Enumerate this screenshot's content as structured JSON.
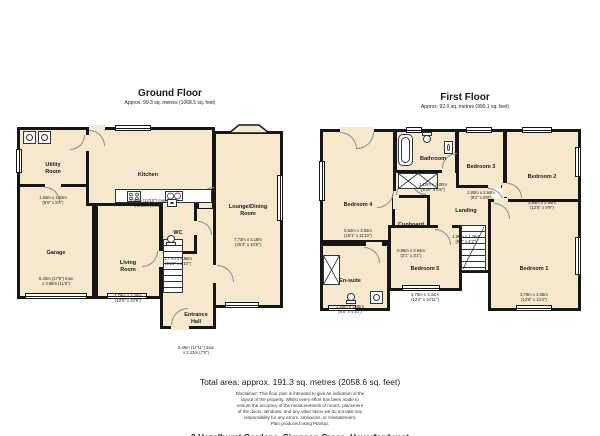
{
  "colors": {
    "room_fill": "#f6e8cd",
    "wall": "#161616",
    "background": "#ffffff"
  },
  "ground": {
    "title": "Ground Floor",
    "subtitle": "Approx. 99.3 sq. metres (1068.5 sq. feet)",
    "rooms": {
      "utility": {
        "name": "Utility\nRoom",
        "dims": "1.83m x 1.63m\n(6'0\" x 5'4\")"
      },
      "kitchen": {
        "name": "Kitchen",
        "dims": "3.90m (12'10\") max\nx 3.00m (9'10\")"
      },
      "lounge": {
        "name": "Lounge/Dining\nRoom",
        "dims": "7.73m x 3.18m\n(25'4\" x 10'5\")"
      },
      "garage": {
        "name": "Garage",
        "dims": "5.40m (17'9\") max\nx 3.58m (11'9\")"
      },
      "living": {
        "name": "Living\nRoom",
        "dims": "3.79m x 3.28m\n(12'5\" x 10'9\")"
      },
      "wc": {
        "name": "WC",
        "dims": "1.77m x 0.86m\n(5'10\" x 2'10\")"
      },
      "hall": {
        "name": "Entrance\nHall",
        "dims": "5.46m (17'11\") max\nx 2.13m (7'0\")"
      }
    }
  },
  "first": {
    "title": "First Floor",
    "subtitle": "Approx. 92.0 sq. metres (990.1 sq. feet)",
    "rooms": {
      "bedroom4": {
        "name": "Bedroom 4",
        "dims": "5.52m x 3.62m\n(18'1\" x 11'10\")"
      },
      "bathroom": {
        "name": "Bathroom",
        "dims": "2.10m x 2.00m\n(6'10\" x 6'6\")"
      },
      "bedroom3": {
        "name": "Bedroom 3",
        "dims": "2.80m x 2.64m\n(9'2\" x 8'8\")"
      },
      "bedroom2": {
        "name": "Bedroom 2",
        "dims": "3.86m x 2.96m\n(12'8\" x 9'9\")"
      },
      "landing": {
        "name": "Landing",
        "dims": "1.88m x 1.26m\n(6'2\" x 4'2\")"
      },
      "cupboard": {
        "name": "Cupboard",
        "dims": "0.95m x 0.94m\n(3'1\" x 3'1\")"
      },
      "bedroom5": {
        "name": "Bedroom 5",
        "dims": "3.70m x 3.34m\n(12'2\" x 10'11\")"
      },
      "bedroom1": {
        "name": "Bedroom 1",
        "dims": "3.78m x 4.06m\n(12'5\" x 13'4\")"
      },
      "ensuite": {
        "name": "En-suite",
        "dims": "1.98m x 1.48m\n(6'6\" x 4'10\")"
      }
    }
  },
  "footer": {
    "total": "Total area: approx. 191.3 sq. metres (2058.6 sq. feet)",
    "disclaimer": "Disclaimer: This floor plan is intended to give an indication of the\nlayout of the property. Whilst every effort has been made to\nensure the accuracy of the measurements of rooms, placement\nof the doors, windows, and any other items we do not take any\nresponsibility for any errors, omissions, or misstatement.\nPlan produced using PlanUp.",
    "address": "2 Hazelhurst Gardens, Simpson Cross, Haverfordwest"
  }
}
